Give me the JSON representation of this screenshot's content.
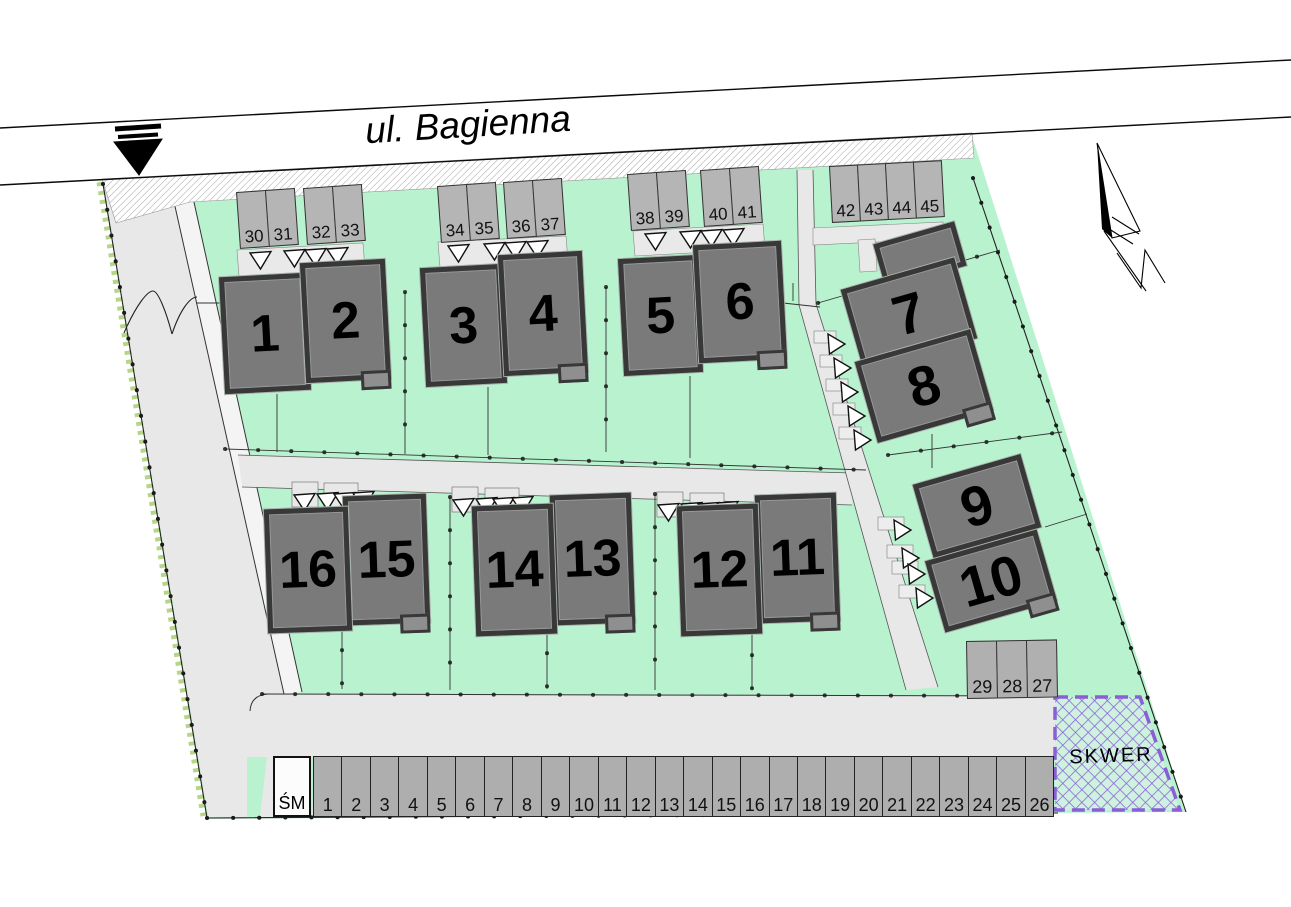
{
  "street": {
    "name": "ul. Bagienna"
  },
  "skwer": {
    "label": "SKWER"
  },
  "buildings": {
    "labels": [
      "1",
      "2",
      "3",
      "4",
      "5",
      "6",
      "7",
      "8",
      "9",
      "10",
      "11",
      "12",
      "13",
      "14",
      "15",
      "16"
    ]
  },
  "parking": {
    "top_groups": [
      {
        "stalls": [
          "30",
          "31"
        ]
      },
      {
        "stalls": [
          "32",
          "33"
        ]
      },
      {
        "stalls": [
          "34",
          "35"
        ]
      },
      {
        "stalls": [
          "36",
          "37"
        ]
      },
      {
        "stalls": [
          "38",
          "39"
        ]
      },
      {
        "stalls": [
          "40",
          "41"
        ]
      },
      {
        "stalls": [
          "42",
          "43",
          "44",
          "45"
        ]
      }
    ],
    "right_group": {
      "stalls": [
        "29",
        "28",
        "27"
      ]
    },
    "bottom_row": {
      "stalls": [
        "1",
        "2",
        "3",
        "4",
        "5",
        "6",
        "7",
        "8",
        "9",
        "10",
        "11",
        "12",
        "13",
        "14",
        "15",
        "16",
        "17",
        "18",
        "19",
        "20",
        "21",
        "22",
        "23",
        "24",
        "25",
        "26"
      ]
    },
    "trash_label": "ŚM"
  },
  "colors": {
    "site_green": "#b9f2cf",
    "skwer_green": "#cff2e0",
    "road_gray": "#e8e8e8",
    "stall_gray": "#b5b5b5",
    "building_gray": "#7a7a7a",
    "building_border": "#383838",
    "skwer_purple": "#8a5fd6"
  }
}
